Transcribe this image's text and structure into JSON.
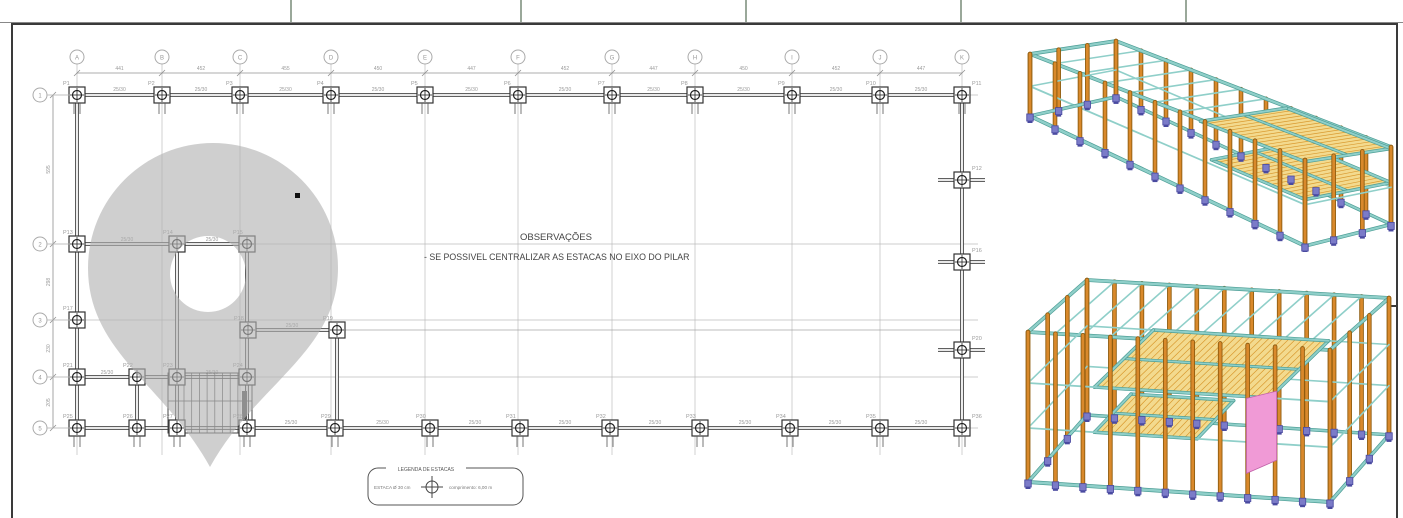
{
  "sheet": {
    "background": "#ffffff",
    "border_color": "#3a3a3a",
    "top_strip_divider_color": "#9aa89a",
    "top_strip_divider_xs": [
      290,
      520,
      745,
      960,
      1185
    ],
    "right_edge_tick_y": 306
  },
  "plan": {
    "line_color": "#4a4a4a",
    "grid_color": "#bcbcbc",
    "label_color": "#9a9a9a",
    "observations": {
      "heading": "OBSERVAÇÕES",
      "note": "- SE POSSIVEL CENTRALIZAR AS ESTACAS NO EIXO DO PILAR"
    },
    "grid_columns": [
      {
        "label": "A",
        "x": 77
      },
      {
        "label": "B",
        "x": 162
      },
      {
        "label": "C",
        "x": 240
      },
      {
        "label": "D",
        "x": 331
      },
      {
        "label": "E",
        "x": 425
      },
      {
        "label": "F",
        "x": 518
      },
      {
        "label": "G",
        "x": 612
      },
      {
        "label": "H",
        "x": 695
      },
      {
        "label": "I",
        "x": 792
      },
      {
        "label": "J",
        "x": 880
      },
      {
        "label": "K",
        "x": 962
      }
    ],
    "grid_rows": [
      {
        "label": "1",
        "y": 95
      },
      {
        "label": "2",
        "y": 244
      },
      {
        "label": "3",
        "y": 320
      },
      {
        "label": "4",
        "y": 377
      },
      {
        "label": "5",
        "y": 428
      }
    ],
    "top_dimensions": [
      "441",
      "452",
      "455",
      "450",
      "447",
      "452",
      "447",
      "450",
      "452",
      "447"
    ],
    "left_dimensions": [
      "595",
      "298",
      "230",
      "205"
    ],
    "beam_section_label": "25/30",
    "piles": [
      {
        "label": "P1",
        "x": 77,
        "y": 95
      },
      {
        "label": "P2",
        "x": 162,
        "y": 95
      },
      {
        "label": "P3",
        "x": 240,
        "y": 95
      },
      {
        "label": "P4",
        "x": 331,
        "y": 95
      },
      {
        "label": "P5",
        "x": 425,
        "y": 95
      },
      {
        "label": "P6",
        "x": 518,
        "y": 95
      },
      {
        "label": "P7",
        "x": 612,
        "y": 95
      },
      {
        "label": "P8",
        "x": 695,
        "y": 95
      },
      {
        "label": "P9",
        "x": 792,
        "y": 95
      },
      {
        "label": "P10",
        "x": 880,
        "y": 95
      },
      {
        "label": "P11",
        "x": 962,
        "y": 95
      },
      {
        "label": "P12",
        "x": 962,
        "y": 180
      },
      {
        "label": "P13",
        "x": 77,
        "y": 244
      },
      {
        "label": "P14",
        "x": 177,
        "y": 244
      },
      {
        "label": "P15",
        "x": 247,
        "y": 244
      },
      {
        "label": "P16",
        "x": 962,
        "y": 262
      },
      {
        "label": "P17",
        "x": 77,
        "y": 320
      },
      {
        "label": "P18",
        "x": 248,
        "y": 330
      },
      {
        "label": "P19",
        "x": 337,
        "y": 330
      },
      {
        "label": "P20",
        "x": 962,
        "y": 350
      },
      {
        "label": "P21",
        "x": 77,
        "y": 377
      },
      {
        "label": "P22",
        "x": 137,
        "y": 377
      },
      {
        "label": "P23",
        "x": 177,
        "y": 377
      },
      {
        "label": "P24",
        "x": 247,
        "y": 377
      },
      {
        "label": "P25",
        "x": 77,
        "y": 428
      },
      {
        "label": "P26",
        "x": 137,
        "y": 428
      },
      {
        "label": "P27",
        "x": 177,
        "y": 428
      },
      {
        "label": "P28",
        "x": 247,
        "y": 428
      },
      {
        "label": "P29",
        "x": 335,
        "y": 428
      },
      {
        "label": "P30",
        "x": 430,
        "y": 428
      },
      {
        "label": "P31",
        "x": 520,
        "y": 428
      },
      {
        "label": "P32",
        "x": 610,
        "y": 428
      },
      {
        "label": "P33",
        "x": 700,
        "y": 428
      },
      {
        "label": "P34",
        "x": 790,
        "y": 428
      },
      {
        "label": "P35",
        "x": 880,
        "y": 428
      },
      {
        "label": "P36",
        "x": 962,
        "y": 428
      }
    ],
    "legend": {
      "title": "LEGENDA DE ESTACAS",
      "left_text": "ESTACA Ø 30 cm",
      "right_text": "comprimento: 6,00 m"
    },
    "watermark": {
      "shape": "location-pin",
      "color": "#B2B2B2",
      "opacity": 0.62
    }
  },
  "models": {
    "colors": {
      "column": "#D9892B",
      "column_edge": "#8F5D10",
      "beam": "#8FCFC9",
      "beam_edge": "#4D9E96",
      "slab": "#F3DA8E",
      "slab_hatch": "#D99A30",
      "footing": "#7B7BC8",
      "footing_edge": "#4A4AA0",
      "stair": "#F09AD6"
    },
    "top_view": "3d-frame-isometric-upper",
    "bottom_view": "3d-frame-isometric-lower"
  }
}
